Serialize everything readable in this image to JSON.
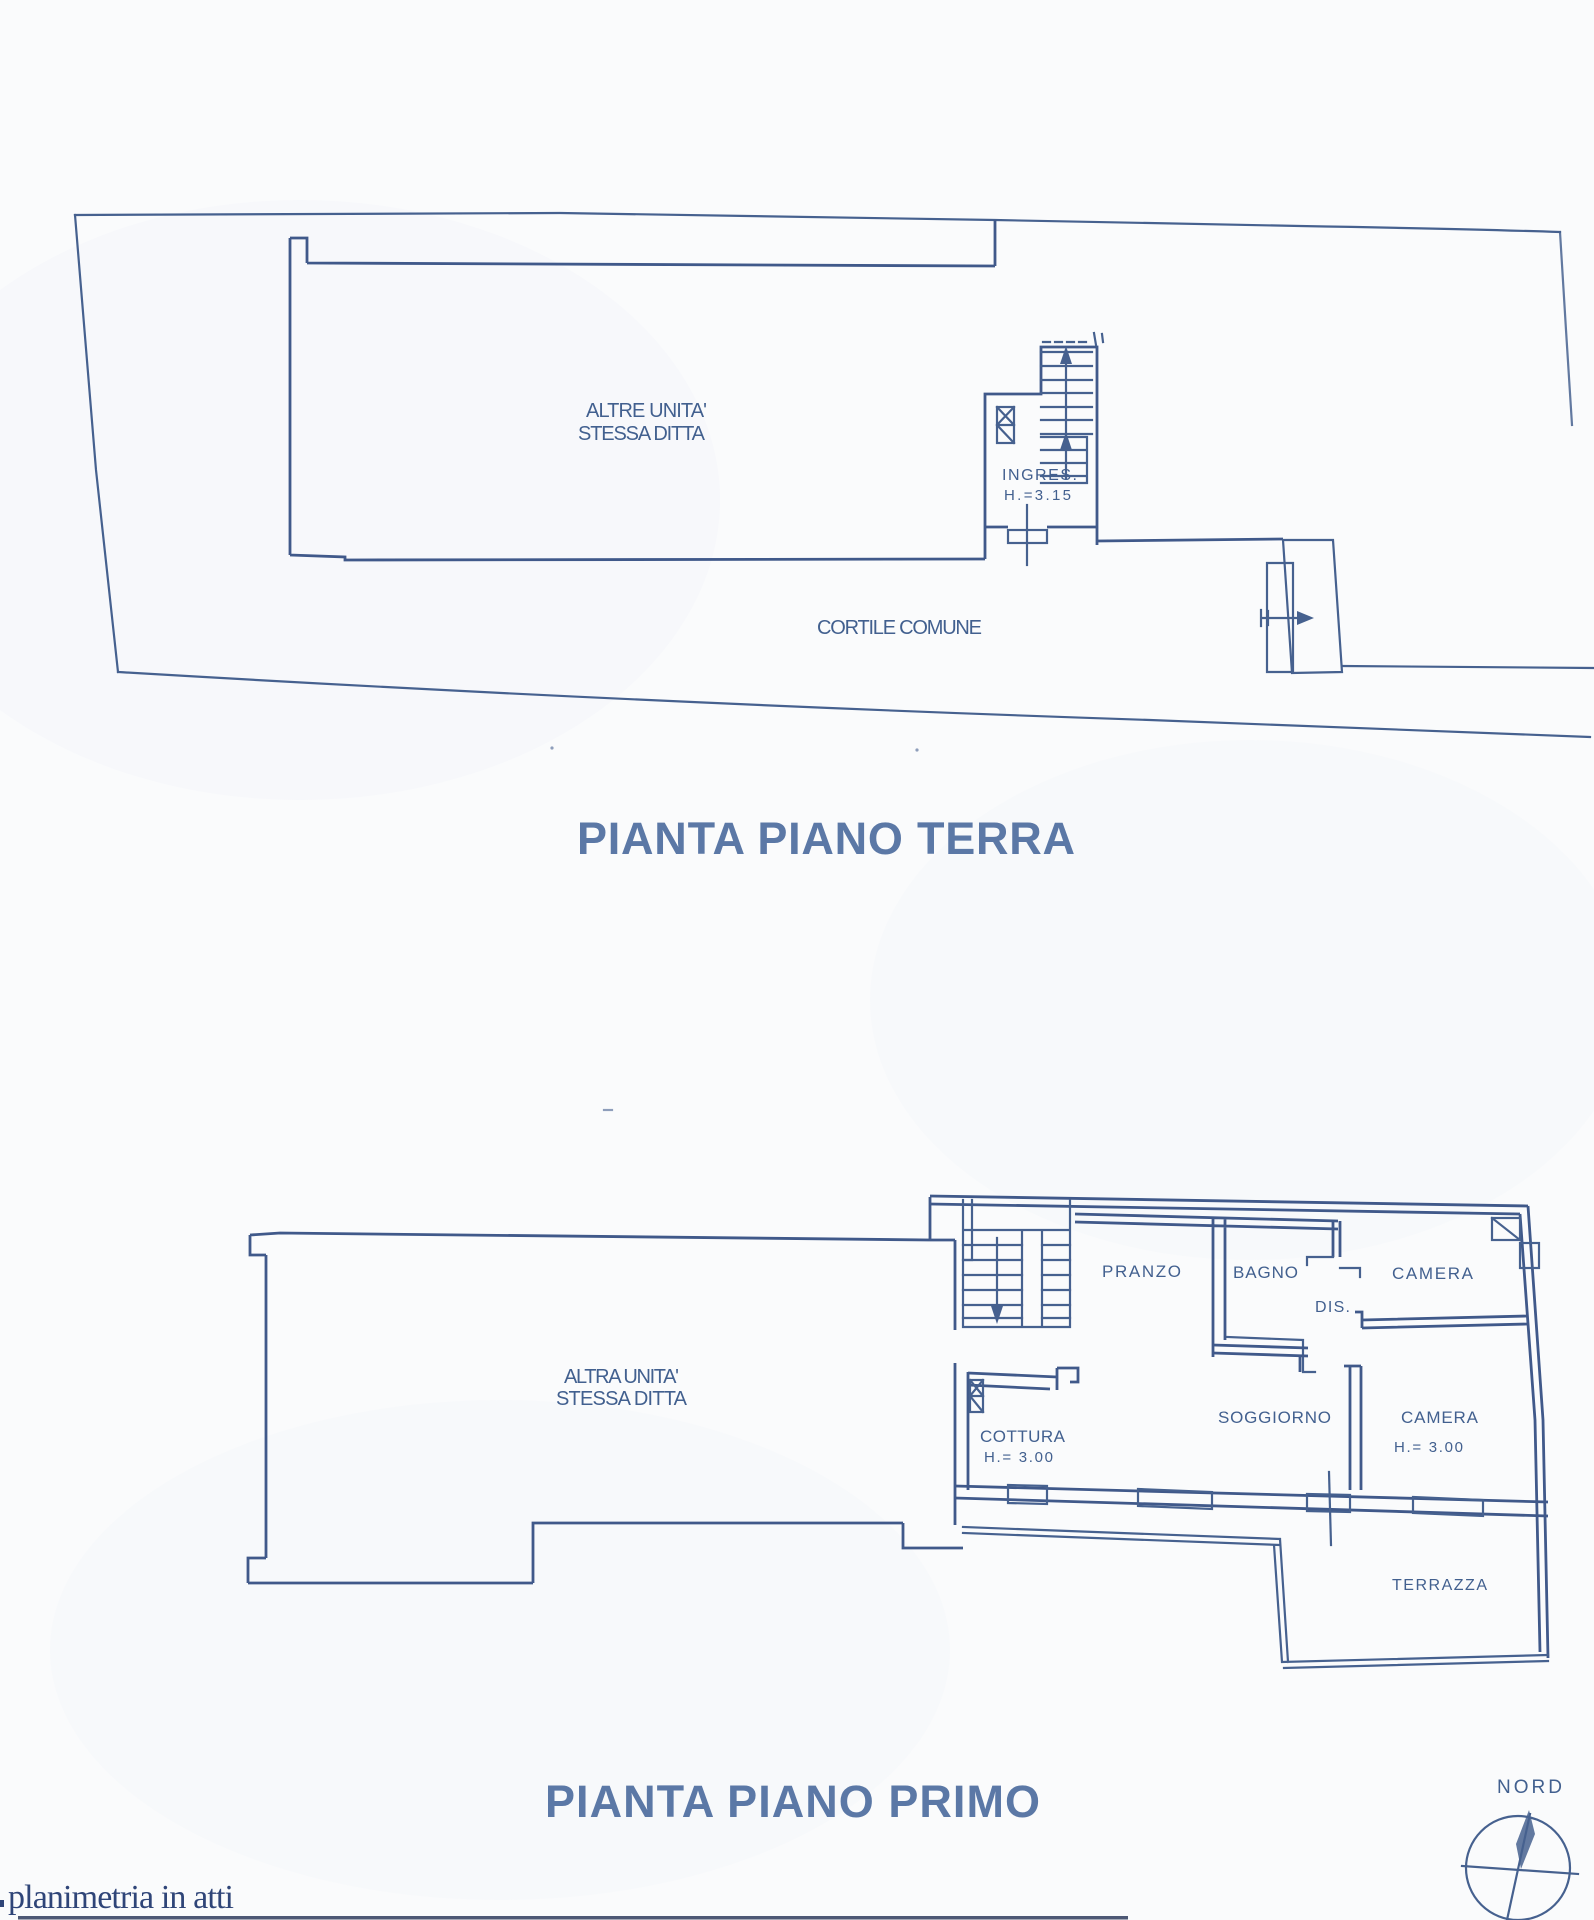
{
  "document": {
    "type_note": "scanned cadastral floor plan drawing",
    "colors": {
      "paper": "#fafbfc",
      "ink": "#46618f",
      "label_ink": "#42608f",
      "title_ink": "#5b78a6",
      "footer_ink": "#2f4578",
      "edge_artifact": "#223052"
    }
  },
  "ground_floor": {
    "title": "PIANTA PIANO TERRA",
    "labels": {
      "other_unit_line1": "ALTRE UNITA'",
      "other_unit_line2": "STESSA DITTA",
      "entrance": "INGRES.",
      "entrance_height": "H.=3.15",
      "courtyard": "CORTILE COMUNE"
    }
  },
  "first_floor": {
    "title": "PIANTA PIANO PRIMO",
    "labels": {
      "other_unit_line1": "ALTRA UNITA'",
      "other_unit_line2": "STESSA DITTA",
      "dining": "PRANZO",
      "bathroom": "BAGNO",
      "bedroom1": "CAMERA",
      "hallway": "DIS.",
      "living": "SOGGIORNO",
      "bedroom2": "CAMERA",
      "bedroom2_height": "H.= 3.00",
      "kitchenette": "COTTURA",
      "kitchenette_height": "H.= 3.00",
      "terrace": "TERRAZZA"
    }
  },
  "compass": {
    "label": "NORD"
  },
  "footer": {
    "note": "planimetria in atti"
  }
}
